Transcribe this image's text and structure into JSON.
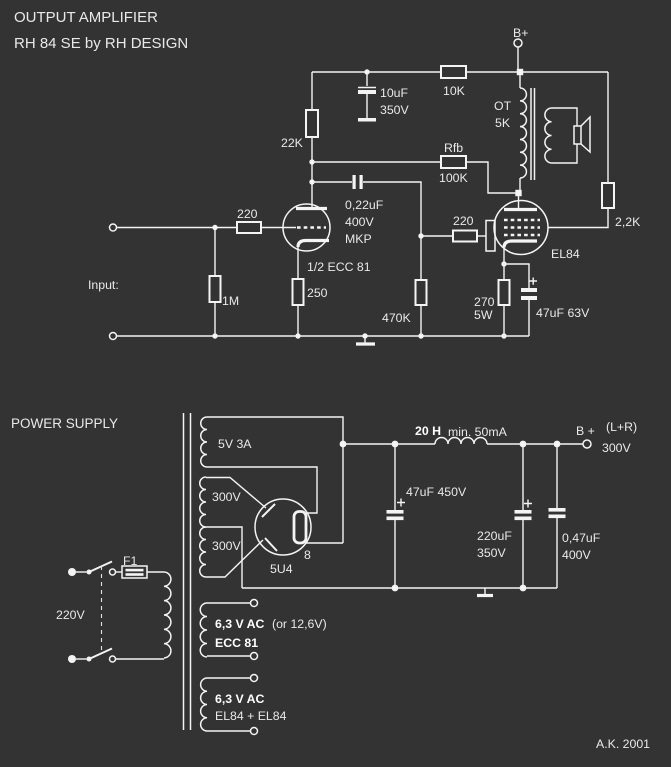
{
  "page": {
    "title": "OUTPUT AMPLIFIER",
    "subtitle": "RH 84 SE  by RH DESIGN",
    "credit": "A.K.   2001",
    "colors": {
      "background": "#333333",
      "line": "#f4f4f4",
      "text": "#e9e9e9",
      "text_bold": "#ffffff"
    }
  },
  "amplifier": {
    "bplus_label": "B+",
    "decoupling_cap": {
      "value": "10uF",
      "voltage": "350V"
    },
    "decoupling_resistor": "10K",
    "output_transformer": {
      "name": "OT",
      "impedance": "5K"
    },
    "anode_resistor": "22K",
    "feedback_resistor": {
      "name": "Rfb",
      "value": "100K"
    },
    "grid_stopper_ecc81": "220",
    "coupling_cap": {
      "value": "0,22uF",
      "voltage": "400V",
      "type": "MKP"
    },
    "tube1_label": "1/2  ECC 81",
    "input_label": "Input:",
    "input_resistor": "1M",
    "cathode_resistor_ecc81": "250",
    "grid_leak_el84": "470K",
    "grid_stopper_el84": "220",
    "tube2_label": "EL84",
    "secondary_resistor": "2,2K",
    "cathode_resistor_el84": {
      "value": "270",
      "power": "5W"
    },
    "cathode_cap_el84": "47uF  63V"
  },
  "power_supply": {
    "section_title": "POWER SUPPLY",
    "heater_winding_rectifier": "5V 3A",
    "ht_winding_upper": "300V",
    "ht_winding_lower": "300V",
    "choke": {
      "value": "20 H",
      "rating": "min. 50mA"
    },
    "output": {
      "label": "B +",
      "channels": "(L+R)",
      "voltage": "300V"
    },
    "filter_cap1": "47uF 450V",
    "filter_cap2": {
      "value": "220uF",
      "voltage": "350V"
    },
    "filter_cap3": {
      "value": "0,47uF",
      "voltage": "400V"
    },
    "rectifier_label": "5U4",
    "rectifier_pin": "8",
    "fuse_label": "F1",
    "mains_label": "220V",
    "heater_winding1": {
      "value": "6,3 V AC",
      "alt": "(or 12,6V)",
      "tube": "ECC 81"
    },
    "heater_winding2": {
      "value": "6,3 V AC",
      "tube": "EL84 + EL84"
    }
  }
}
